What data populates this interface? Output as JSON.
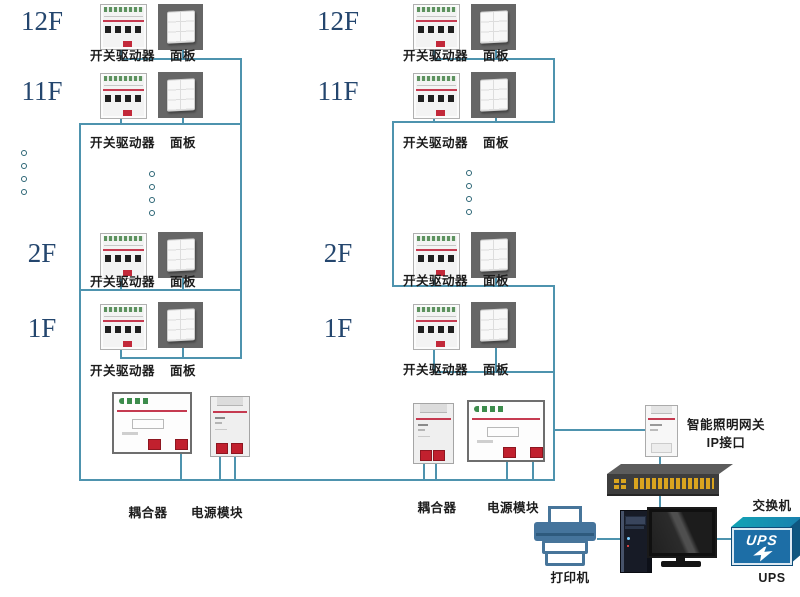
{
  "colors": {
    "wire": "#4e93ae",
    "floor_label": "#24466e"
  },
  "left_column": {
    "floors": [
      {
        "floor": "12F",
        "driver": "开关驱动器",
        "panel": "面板"
      },
      {
        "floor": "11F",
        "driver": "开关驱动器",
        "panel": "面板"
      },
      {
        "floor": "2F",
        "driver": "开关驱动器",
        "panel": "面板"
      },
      {
        "floor": "1F",
        "driver": "开关驱动器",
        "panel": "面板"
      }
    ],
    "coupler": "耦合器",
    "power_module": "电源模块"
  },
  "right_column": {
    "floors": [
      {
        "floor": "12F",
        "driver": "开关驱动器",
        "panel": "面板"
      },
      {
        "floor": "11F",
        "driver": "开关驱动器",
        "panel": "面板"
      },
      {
        "floor": "2F",
        "driver": "开关驱动器",
        "panel": "面板"
      },
      {
        "floor": "1F",
        "driver": "开关驱动器",
        "panel": "面板"
      }
    ],
    "coupler": "耦合器",
    "power_module": "电源模块"
  },
  "gateway": {
    "line1": "智能照明网关",
    "line2": "IP接口"
  },
  "network_switch": {
    "label": "交换机"
  },
  "printer": {
    "label": "打印机"
  },
  "ups": {
    "box_label": "UPS",
    "label": "UPS"
  }
}
